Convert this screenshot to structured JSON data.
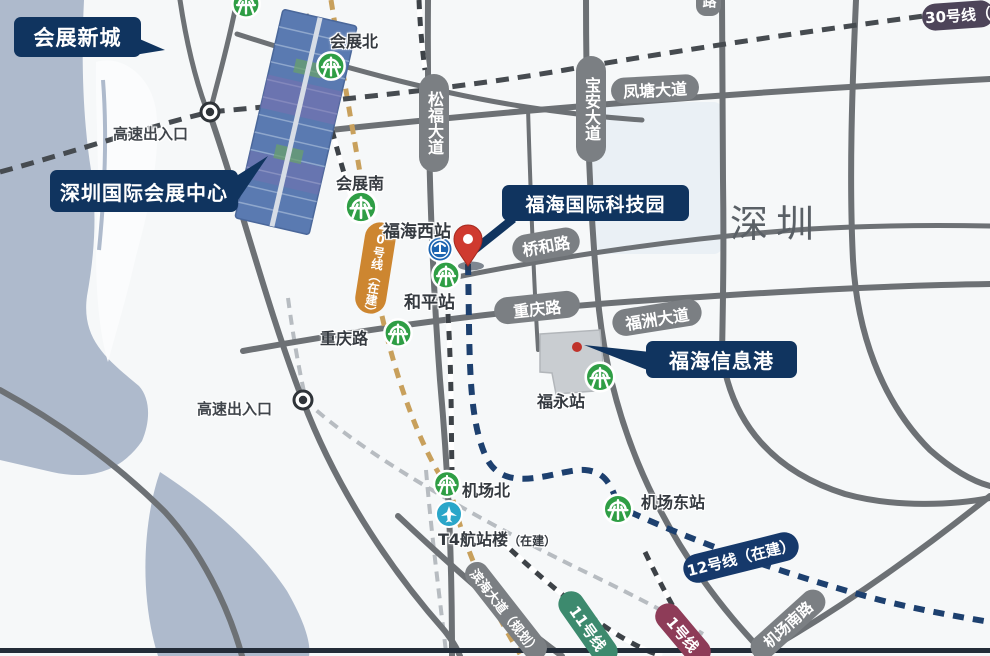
{
  "callouts": {
    "new_city": "会展新城",
    "convention_center": "深圳国际会展中心",
    "tech_park": "福海国际科技园",
    "info_port": "福海信息港"
  },
  "stations": {
    "huizhan_north": "会展北",
    "huizhan_south": "会展南",
    "fuhai_west": "福海西站",
    "heping": "和平站",
    "fuyong": "福永站",
    "airport_north": "机场北",
    "airport_east": "机场东站",
    "t4_terminal": "T4航站楼",
    "t4_note": "（在建）"
  },
  "roads": {
    "fengtang": "凤塘大道",
    "songfu": "松福大道",
    "baoan": "宝安大道",
    "qiaohe": "桥和路",
    "chongqing_pill": "重庆路",
    "chongqing_text": "重庆路",
    "fuzhou": "福洲大道",
    "jichang_south": "机场南路",
    "binhai_planned": "滨海大道（规划）",
    "partial_top": "路"
  },
  "metro_lines": {
    "line30": "30号线（",
    "line20": "20号线（在建）",
    "line12": "12号线（在建）",
    "line11": "11号线",
    "line1": "1号线"
  },
  "annotations": {
    "expressway_exit_1": "高速出入口",
    "expressway_exit_2": "高速出入口",
    "city": "深圳"
  },
  "icons": {
    "metro": "shenzhen-metro-logo",
    "railway": "china-railway-station",
    "airport": "airplane",
    "pin": "location-pin"
  },
  "colors": {
    "callout_navy": "#10345f",
    "road_gray": "#6d7175",
    "pill_gray": "#7b7f83",
    "water": "#aebacc",
    "metro_green": "#2f9e45",
    "rail_blue": "#1c64b0",
    "pin_red": "#cf3a2f",
    "line20_orange": "#cd8630",
    "line12_navy": "#16396b",
    "line11_green": "#3d8a6e",
    "line1_maroon": "#8e3c58",
    "line30_purple": "#4d4459",
    "airport_teal": "#2aa6c9"
  }
}
